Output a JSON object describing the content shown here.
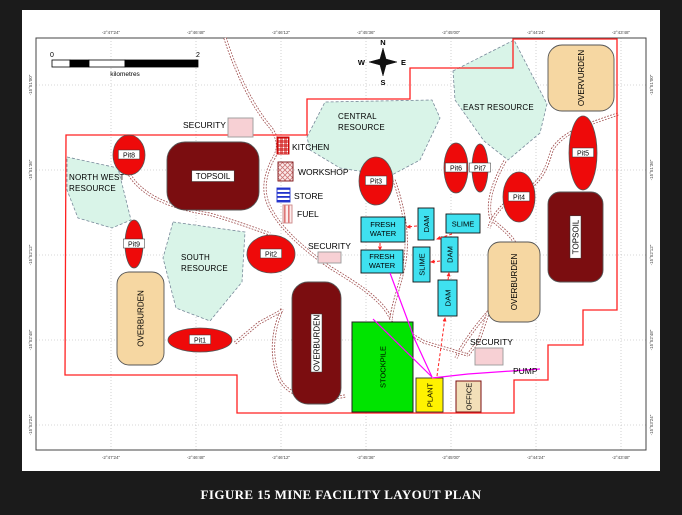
{
  "figure": {
    "caption": "FIGURE 15 MINE FACILITY LAYOUT PLAN"
  },
  "colors": {
    "pit_red": "#ee0a0a",
    "maroon": "#7b0d10",
    "tan": "#f6d7a2",
    "mint": "#d9f4e8",
    "cyan": "#3fe1f0",
    "stockpile_green": "#00e400",
    "plant_yellow": "#fff200",
    "office_tan": "#f2dfb8",
    "security_pink": "#f7d0d4",
    "boundary_red": "#ff2020",
    "road": "#a05050",
    "magenta": "#ff00ff",
    "flow_red": "#ff2222"
  },
  "map": {
    "grid": {
      "xs": [
        111,
        196,
        281,
        366,
        451,
        536,
        621
      ],
      "ys": [
        85,
        170,
        255,
        340,
        425
      ]
    },
    "x_ticks": [
      "-2°47'24\"",
      "-2°46'48\"",
      "-2°46'12\"",
      "-2°45'36\"",
      "-2°45'00\"",
      "-2°44'24\"",
      "-2°43'48\""
    ],
    "y_ticks": [
      "-15°51'00\"",
      "-15°51'36\"",
      "-15°52'12\"",
      "-15°52'48\"",
      "-15°53'24\""
    ],
    "scalebar": {
      "x": 52,
      "y": 60,
      "w": 146,
      "h": 7,
      "segs": [
        {
          "w": 18,
          "fill": "#ffffff"
        },
        {
          "w": 19,
          "fill": "#000000"
        },
        {
          "w": 36,
          "fill": "#ffffff"
        },
        {
          "w": 73,
          "fill": "#000000"
        }
      ],
      "label_left": "0",
      "label_right": "2",
      "unit": "kilometres"
    },
    "compass": {
      "cx": 383,
      "cy": 62,
      "n": "N",
      "s": "S",
      "e": "E",
      "w": "W"
    },
    "boundary": [
      [
        66,
        135
      ],
      [
        307,
        135
      ],
      [
        307,
        99
      ],
      [
        410,
        99
      ],
      [
        410,
        68
      ],
      [
        513,
        68
      ],
      [
        513,
        39
      ],
      [
        617,
        39
      ],
      [
        617,
        310
      ],
      [
        583,
        310
      ],
      [
        583,
        345
      ],
      [
        548,
        345
      ],
      [
        548,
        380
      ],
      [
        514,
        380
      ],
      [
        514,
        413
      ],
      [
        237,
        413
      ],
      [
        237,
        375
      ],
      [
        65,
        375
      ]
    ],
    "roads": [
      "M225,38 C236,72 252,106 271,128 C279,140 280,149 272,161 C263,180 262,196 273,213 C282,229 303,249 331,268 C357,284 382,299 391,319",
      "M128,172 C140,195 170,208 209,214 C235,221 255,229 270,234",
      "M394,180 C403,206 410,236 404,266 C399,289 392,306 391,320",
      "M505,161 C494,181 486,201 491,219 C505,231 516,238 518,253 C520,276 506,296 489,311 C476,326 463,343 456,358",
      "M618,114 C592,123 563,131 552,150 C546,170 541,183 521,193 C506,201 493,213 489,228",
      "M282,309 C272,332 270,357 280,380 C290,398 318,402 345,396",
      "M235,343 L259,323 L283,310",
      "M391,322 L424,342 L468,355",
      "M468,355 L479,340 L488,313"
    ],
    "resources": [
      {
        "name": "north-west-resource",
        "pts": "67,157 118,168 131,220 112,228 78,218 67,190",
        "lines": [
          {
            "t": "NORTH WEST",
            "x": 69,
            "y": 180
          },
          {
            "t": "RESOURCE",
            "x": 69,
            "y": 191
          }
        ]
      },
      {
        "name": "south-resource",
        "pts": "173,222 245,232 242,282 210,321 176,308 163,258",
        "lines": [
          {
            "t": "SOUTH",
            "x": 181,
            "y": 260
          },
          {
            "t": "RESOURCE",
            "x": 181,
            "y": 271
          }
        ]
      },
      {
        "name": "central-resource",
        "pts": "307,137 325,102 432,100 440,118 420,160 390,176 340,168 310,150",
        "lines": [
          {
            "t": "CENTRAL",
            "x": 338,
            "y": 119
          },
          {
            "t": "RESOURCE",
            "x": 338,
            "y": 130
          }
        ]
      },
      {
        "name": "east-resource",
        "pts": "453,71 514,40 547,104 540,133 508,160 484,141 455,100",
        "lines": [
          {
            "t": "EAST RESOURCE",
            "x": 463,
            "y": 110
          }
        ]
      }
    ],
    "zones": [
      {
        "name": "topsoil-main",
        "label": "TOPSOIL",
        "x": 167,
        "y": 142,
        "w": 92,
        "h": 68,
        "r": 18,
        "fill": "maroon",
        "rot": 0,
        "box": true
      },
      {
        "name": "overvurden-ne",
        "label": "OVERVURDEN",
        "x": 548,
        "y": 45,
        "w": 66,
        "h": 66,
        "r": 14,
        "fill": "tan",
        "rot": -90,
        "box": false
      },
      {
        "name": "topsoil-east",
        "label": "TOPSOIL",
        "x": 548,
        "y": 192,
        "w": 55,
        "h": 90,
        "r": 12,
        "fill": "maroon",
        "rot": -90,
        "box": true
      },
      {
        "name": "overburden-east",
        "label": "OVERBURDEN",
        "x": 488,
        "y": 242,
        "w": 52,
        "h": 80,
        "r": 12,
        "fill": "tan",
        "rot": -90,
        "box": false
      },
      {
        "name": "overburden-west",
        "label": "OVERBURDEN",
        "x": 117,
        "y": 272,
        "w": 47,
        "h": 93,
        "r": 12,
        "fill": "tan",
        "rot": -90,
        "box": false
      },
      {
        "name": "overburden-center",
        "label": "OVERBURDEN",
        "x": 292,
        "y": 282,
        "w": 49,
        "h": 122,
        "r": 16,
        "fill": "maroon",
        "rot": -90,
        "box": true
      }
    ],
    "pits": [
      {
        "label": "Pit8",
        "cx": 129,
        "cy": 155,
        "rx": 16,
        "ry": 20
      },
      {
        "label": "Pit9",
        "cx": 134,
        "cy": 244,
        "rx": 9,
        "ry": 24
      },
      {
        "label": "Pit2",
        "cx": 271,
        "cy": 254,
        "rx": 24,
        "ry": 19
      },
      {
        "label": "Pit1",
        "cx": 200,
        "cy": 340,
        "rx": 32,
        "ry": 12
      },
      {
        "label": "Pit3",
        "cx": 376,
        "cy": 181,
        "rx": 17,
        "ry": 24
      },
      {
        "label": "Pit6",
        "cx": 456,
        "cy": 168,
        "rx": 12,
        "ry": 25
      },
      {
        "label": "Pit7",
        "cx": 480,
        "cy": 168,
        "rx": 8,
        "ry": 24
      },
      {
        "label": "Pit4",
        "cx": 519,
        "cy": 197,
        "rx": 16,
        "ry": 25
      },
      {
        "label": "Pit5",
        "cx": 583,
        "cy": 153,
        "rx": 14,
        "ry": 37
      }
    ],
    "boxes": [
      {
        "name": "fresh-water-1",
        "style": "cyan",
        "x": 361,
        "y": 217,
        "w": 44,
        "h": 25,
        "rot": 0,
        "lines": [
          "FRESH",
          "WATER"
        ]
      },
      {
        "name": "fresh-water-2",
        "style": "cyan",
        "x": 361,
        "y": 250,
        "w": 42,
        "h": 23,
        "rot": 0,
        "lines": [
          "FRESH",
          "WATER"
        ]
      },
      {
        "name": "dam-1",
        "style": "cyan",
        "x": 418,
        "y": 208,
        "w": 16,
        "h": 32,
        "rot": -90,
        "lines": [
          "DAM"
        ]
      },
      {
        "name": "slime-1",
        "style": "cyan",
        "x": 446,
        "y": 214,
        "w": 34,
        "h": 19,
        "rot": 0,
        "lines": [
          "SLIME"
        ]
      },
      {
        "name": "slime-2",
        "style": "cyan",
        "x": 413,
        "y": 247,
        "w": 17,
        "h": 35,
        "rot": -90,
        "lines": [
          "SLIME"
        ]
      },
      {
        "name": "dam-2",
        "style": "cyan",
        "x": 441,
        "y": 237,
        "w": 17,
        "h": 35,
        "rot": -90,
        "lines": [
          "DAM"
        ]
      },
      {
        "name": "dam-3",
        "style": "cyan",
        "x": 438,
        "y": 280,
        "w": 19,
        "h": 36,
        "rot": -90,
        "lines": [
          "DAM"
        ]
      },
      {
        "name": "stockpile",
        "style": "stockpile",
        "x": 352,
        "y": 322,
        "w": 61,
        "h": 90,
        "rot": -90,
        "lines": [
          "STOCKPILE"
        ]
      },
      {
        "name": "plant",
        "style": "plant",
        "x": 416,
        "y": 378,
        "w": 27,
        "h": 34,
        "rot": -90,
        "lines": [
          "PLANT"
        ]
      },
      {
        "name": "office",
        "style": "office",
        "x": 456,
        "y": 381,
        "w": 25,
        "h": 31,
        "rot": -90,
        "lines": [
          "OFFICE"
        ]
      },
      {
        "name": "security-box-1",
        "style": "security",
        "x": 228,
        "y": 118,
        "w": 25,
        "h": 19,
        "rot": 0,
        "lines": []
      },
      {
        "name": "security-box-2",
        "style": "security",
        "x": 318,
        "y": 252,
        "w": 23,
        "h": 11,
        "rot": 0,
        "lines": []
      },
      {
        "name": "security-box-3",
        "style": "security",
        "x": 475,
        "y": 348,
        "w": 28,
        "h": 17,
        "rot": 0,
        "lines": []
      },
      {
        "name": "kitchen-box",
        "style": "kitchen",
        "x": 277,
        "y": 137,
        "w": 12,
        "h": 17,
        "rot": 0,
        "lines": []
      },
      {
        "name": "workshop-box",
        "style": "workshop",
        "x": 278,
        "y": 162,
        "w": 15,
        "h": 19,
        "rot": 0,
        "lines": []
      },
      {
        "name": "store-box",
        "style": "store",
        "x": 277,
        "y": 188,
        "w": 13,
        "h": 14,
        "rot": 0,
        "lines": []
      },
      {
        "name": "fuel-box",
        "style": "fuel",
        "x": 283,
        "y": 205,
        "w": 9,
        "h": 18,
        "rot": 0,
        "lines": []
      }
    ],
    "out_labels": [
      {
        "t": "SECURITY",
        "x": 183,
        "y": 128
      },
      {
        "t": "KITCHEN",
        "x": 292,
        "y": 150
      },
      {
        "t": "WORKSHOP",
        "x": 298,
        "y": 175
      },
      {
        "t": "STORE",
        "x": 294,
        "y": 199
      },
      {
        "t": "FUEL",
        "x": 297,
        "y": 217
      },
      {
        "t": "SECURITY",
        "x": 308,
        "y": 249
      },
      {
        "t": "SECURITY",
        "x": 470,
        "y": 345
      },
      {
        "t": "PUMP",
        "x": 513,
        "y": 374
      }
    ],
    "magenta": [
      "M390,273 L415,340 L432,377",
      "M373,319 L432,377",
      "M432,378 L468,374 L540,369"
    ],
    "flow_arrows": [
      {
        "x1": 417,
        "y1": 226,
        "x2": 407,
        "y2": 227
      },
      {
        "x1": 452,
        "y1": 234,
        "x2": 437,
        "y2": 239
      },
      {
        "x1": 380,
        "y1": 243,
        "x2": 380,
        "y2": 250
      },
      {
        "x1": 440,
        "y1": 261,
        "x2": 431,
        "y2": 262
      },
      {
        "x1": 448,
        "y1": 280,
        "x2": 449,
        "y2": 273
      },
      {
        "x1": 437,
        "y1": 376,
        "x2": 445,
        "y2": 318
      }
    ]
  }
}
